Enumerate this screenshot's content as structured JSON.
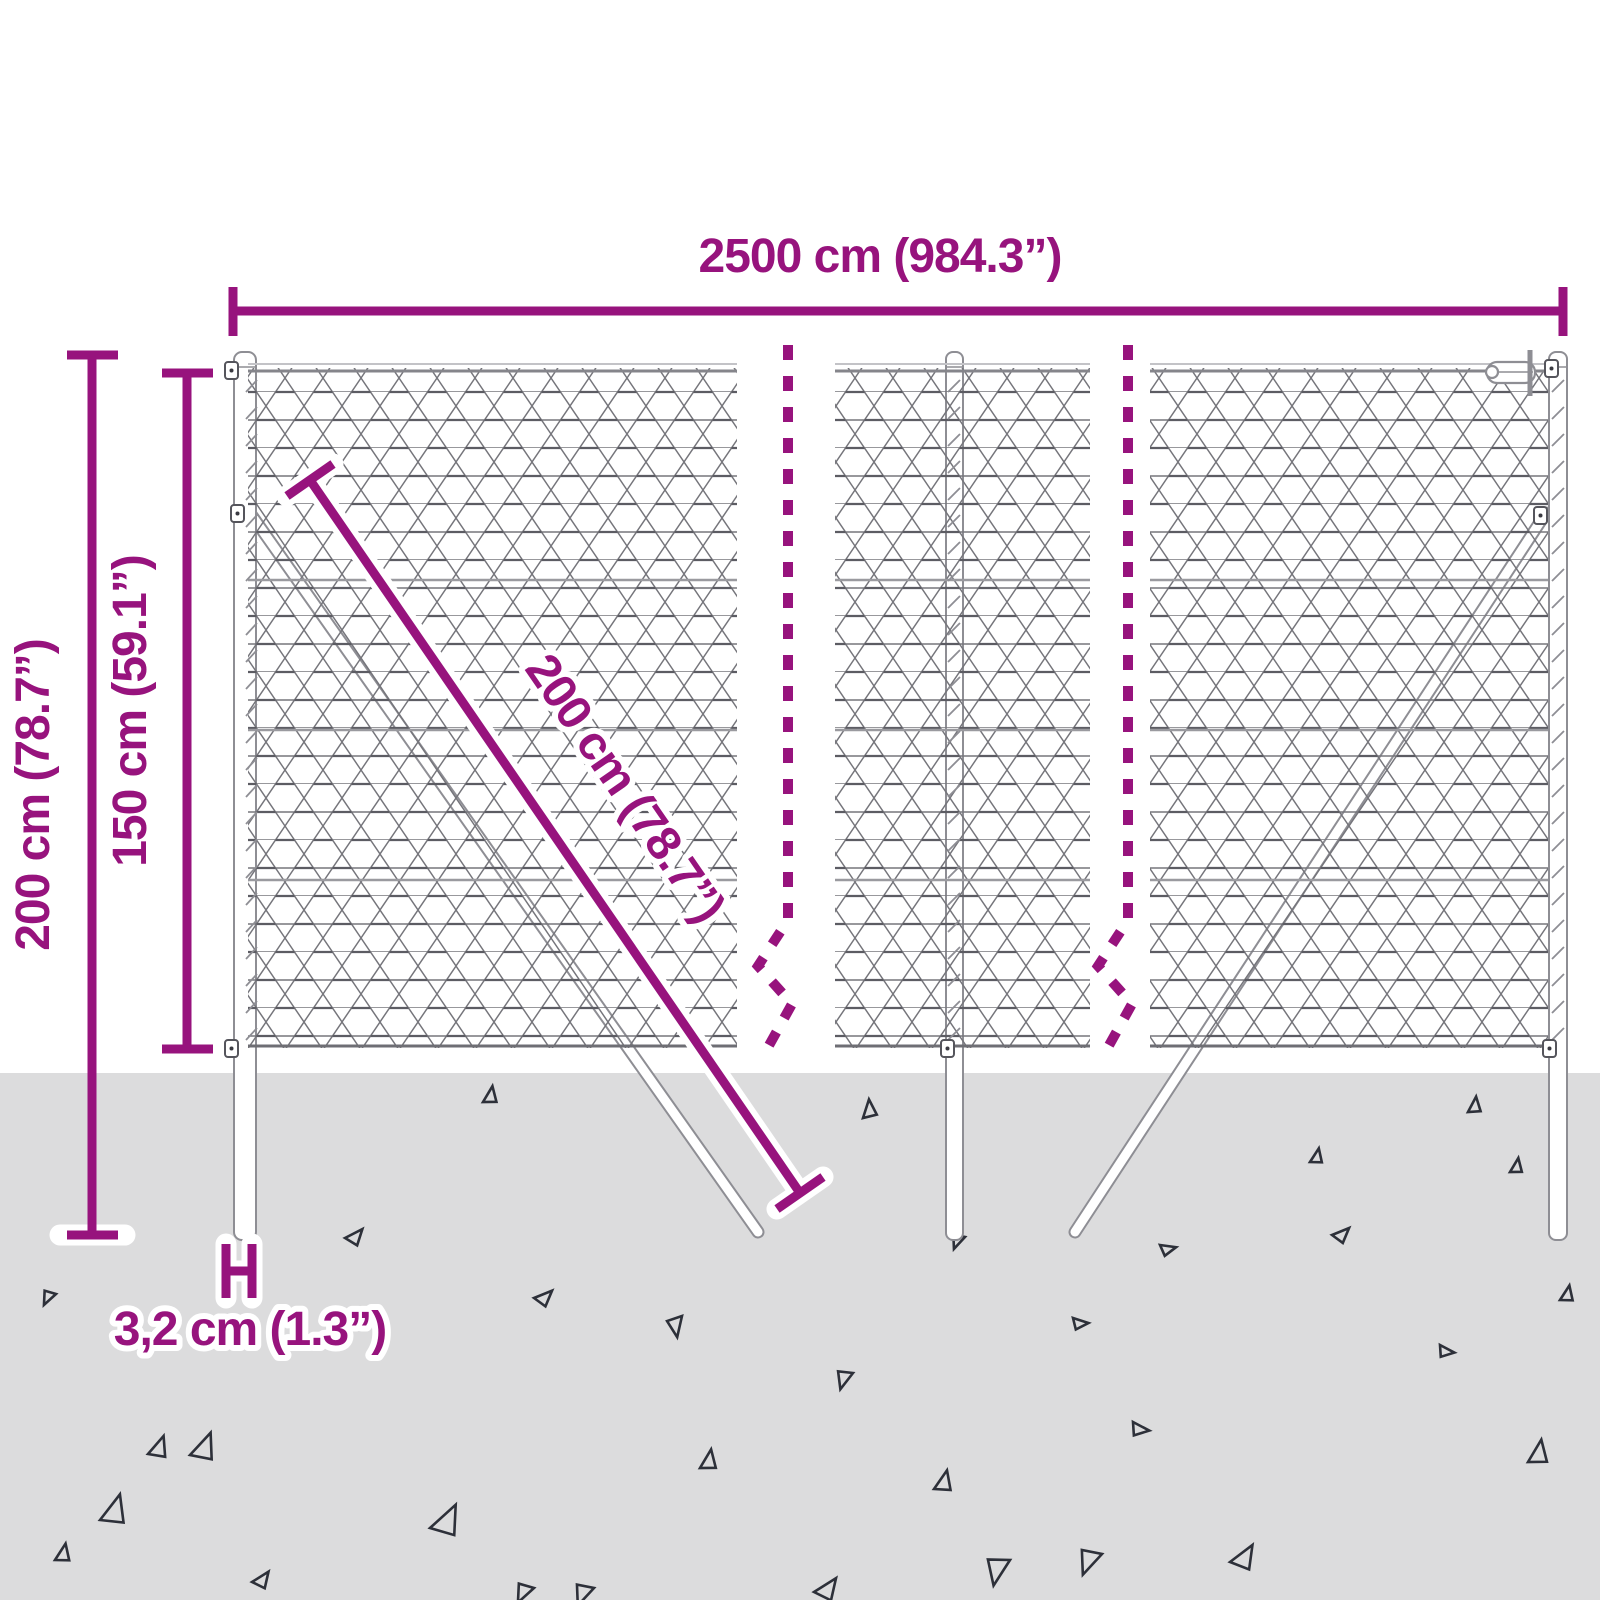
{
  "title": "Chain-link fence dimension diagram",
  "colors": {
    "background": "#ffffff",
    "ground": "#dcdcdd",
    "accent": "#97137d",
    "mesh": "#75757b",
    "mesh_dark": "#5c5c63",
    "outline": "#8e8e94",
    "post_fill": "#ffffff",
    "triangle": "#2d3039"
  },
  "dimensions": {
    "width_label": "2500 cm (984.3”)",
    "outer_height_label": "200 cm (78.7”)",
    "inner_height_label": "150 cm (59.1”)",
    "brace_length_label": "200 cm (78.7”)",
    "post_diameter_label": "3,2 cm (1.3”)"
  },
  "scene": {
    "fence_panel_count": 3,
    "post_count": 3,
    "brace_count": 2,
    "break_line_count": 2,
    "triangles": [
      [
        483,
        1102,
        17,
        8
      ],
      [
        863,
        1118,
        18,
        355
      ],
      [
        965,
        1237,
        15,
        200
      ],
      [
        1310,
        1162,
        15,
        10
      ],
      [
        1468,
        1112,
        16,
        5
      ],
      [
        1510,
        1172,
        15,
        8
      ],
      [
        56,
        1294,
        15,
        205
      ],
      [
        100,
        1520,
        30,
        15
      ],
      [
        148,
        1454,
        22,
        18
      ],
      [
        55,
        1560,
        18,
        10
      ],
      [
        252,
        1582,
        18,
        35
      ],
      [
        345,
        1238,
        18,
        40
      ],
      [
        534,
        1298,
        18,
        45
      ],
      [
        190,
        1455,
        28,
        20
      ],
      [
        430,
        1528,
        32,
        25
      ],
      [
        534,
        1588,
        20,
        205
      ],
      [
        682,
        1316,
        20,
        170
      ],
      [
        700,
        1468,
        20,
        8
      ],
      [
        594,
        1588,
        22,
        200
      ],
      [
        853,
        1373,
        19,
        195
      ],
      [
        934,
        1489,
        21,
        12
      ],
      [
        814,
        1592,
        24,
        35
      ],
      [
        1073,
        1318,
        15,
        85
      ],
      [
        1133,
        1422,
        17,
        95
      ],
      [
        1102,
        1554,
        26,
        200
      ],
      [
        1230,
        1562,
        26,
        30
      ],
      [
        1332,
        1235,
        17,
        45
      ],
      [
        1440,
        1345,
        15,
        95
      ],
      [
        1528,
        1462,
        24,
        8
      ],
      [
        1160,
        1245,
        15,
        75
      ],
      [
        1010,
        1560,
        28,
        190
      ],
      [
        1560,
        1300,
        16,
        10
      ]
    ]
  }
}
